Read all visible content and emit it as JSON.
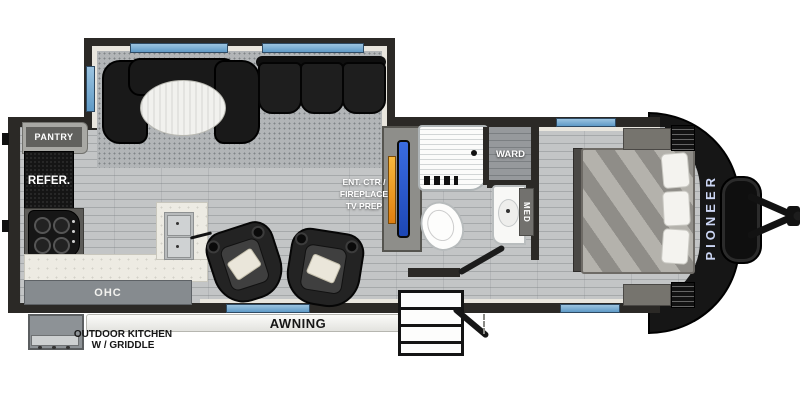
{
  "page": {
    "type": "rv-travel-trailer-floorplan"
  },
  "labels": {
    "pantry": "PANTRY",
    "refrigerator": "REFER.",
    "overhead_cabinet": "OHC",
    "outdoor_kitchen_line1": "OUTDOOR KITCHEN",
    "outdoor_kitchen_line2": "W / GRIDDLE",
    "awning": "AWNING",
    "ent_center_line1": "ENT. CTR /",
    "ent_center_line2": "FIREPLACE",
    "ent_center_line3": "TV PREP",
    "wardrobe": "WARD",
    "medicine_cabinet": "MED",
    "brand": "PIONEER"
  },
  "colors": {
    "wall": "#2b2926",
    "window_glass": "#74a9d1",
    "tv_screen": "#2a5cd8",
    "fireplace_flame": "#f09a1e",
    "brand_text": "#ccd6f4",
    "floor_wood": "#c3c5c6",
    "carpet": "#b2b5b7",
    "counter": "#edebe3",
    "appliance_dark": "#141414"
  }
}
